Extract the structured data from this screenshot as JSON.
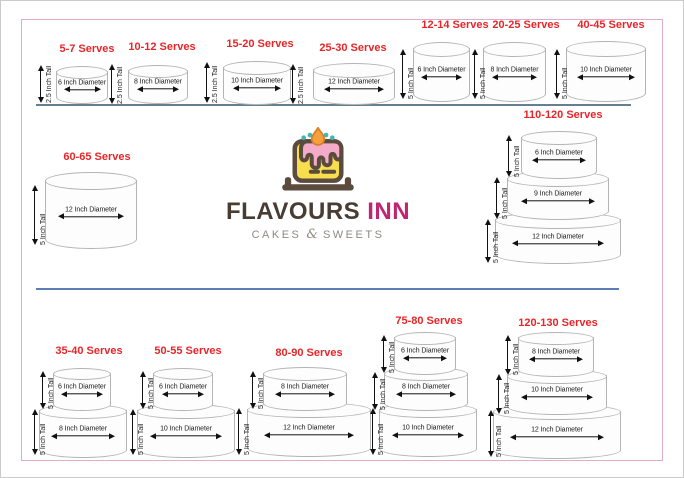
{
  "brand": {
    "name_primary": "FLAVOURS",
    "name_secondary": "INN",
    "tagline_left": "CAKES",
    "tagline_amp": "&",
    "tagline_right": "SWEETS",
    "colors": {
      "primary_text": "#483c33",
      "secondary_text": "#bf2571",
      "tagline_text": "#8d8a82",
      "cake_yellow": "#f8dd4e",
      "frosting_pink": "#f4abc7",
      "outline_brown": "#5b4a3e",
      "flame_orange": "#f5a03c",
      "candle_teal": "#43b6b0"
    }
  },
  "colors": {
    "serves_red": "#e62629",
    "border_pink": "#e2abce",
    "divider_top": "#64808f",
    "divider_bottom": "#5b7fb5",
    "cake_fill": "#fdfdfd",
    "cake_stroke": "#b4b4b4",
    "arrow_black": "#111111"
  },
  "groups": [
    {
      "serves": "5-7 Serves",
      "tiers": [
        {
          "diameter": "6 Inch Diameter",
          "height": "2.5 Inch Tall"
        }
      ]
    },
    {
      "serves": "10-12 Serves",
      "tiers": [
        {
          "diameter": "8 Inch Diameter",
          "height": "2.5 Inch Tall"
        }
      ]
    },
    {
      "serves": "15-20 Serves",
      "tiers": [
        {
          "diameter": "10 Inch Diameter",
          "height": "2.5 Inch Tall"
        }
      ]
    },
    {
      "serves": "25-30 Serves",
      "tiers": [
        {
          "diameter": "12 Inch Diameter",
          "height": "2.5 Inch Tall"
        }
      ]
    },
    {
      "serves": "12-14 Serves",
      "tiers": [
        {
          "diameter": "6 Inch Diameter",
          "height": "5 Inch Tall"
        }
      ]
    },
    {
      "serves": "20-25 Serves",
      "tiers": [
        {
          "diameter": "8 Inch Diameter",
          "height": "5 Inch Tall"
        }
      ]
    },
    {
      "serves": "40-45 Serves",
      "tiers": [
        {
          "diameter": "10 Inch Diameter",
          "height": "5 Inch Tall"
        }
      ]
    },
    {
      "serves": "60-65 Serves",
      "tiers": [
        {
          "diameter": "12 Inch Diameter",
          "height": "5 Inch Tall"
        }
      ]
    },
    {
      "serves": "110-120 Serves",
      "tiers": [
        {
          "diameter": "6 Inch Diameter",
          "height": "5 Inch Tall"
        },
        {
          "diameter": "9 Inch Diameter",
          "height": "5 Inch Tall"
        },
        {
          "diameter": "12 Inch Diameter",
          "height": "5 Inch Tall"
        }
      ]
    },
    {
      "serves": "35-40 Serves",
      "tiers": [
        {
          "diameter": "6 Inch Diameter",
          "height": "5 Inch Tall"
        },
        {
          "diameter": "8 Inch Diameter",
          "height": "5 Inch Tall"
        }
      ]
    },
    {
      "serves": "50-55 Serves",
      "tiers": [
        {
          "diameter": "6 Inch Diameter",
          "height": "5 Inch Tall"
        },
        {
          "diameter": "10 Inch Diameter",
          "height": "5 Inch Tall"
        }
      ]
    },
    {
      "serves": "80-90 Serves",
      "tiers": [
        {
          "diameter": "8 Inch Diameter",
          "height": "5 Inch Tall"
        },
        {
          "diameter": "12 Inch Diameter",
          "height": "5 Inch Tall"
        }
      ]
    },
    {
      "serves": "75-80 Serves",
      "tiers": [
        {
          "diameter": "6 Inch Diameter",
          "height": "5 Inch Tall"
        },
        {
          "diameter": "8 Inch Diameter",
          "height": "5 Inch Tall"
        },
        {
          "diameter": "10 Inch Diameter",
          "height": "5 Inch Tall"
        }
      ]
    },
    {
      "serves": "120-130 Serves",
      "tiers": [
        {
          "diameter": "8 Inch Diameter",
          "height": "5 Inch Tall"
        },
        {
          "diameter": "10 Inch Diameter",
          "height": "5 Inch Tall"
        },
        {
          "diameter": "12 Inch Diameter",
          "height": "5 Inch Tall"
        }
      ]
    }
  ]
}
